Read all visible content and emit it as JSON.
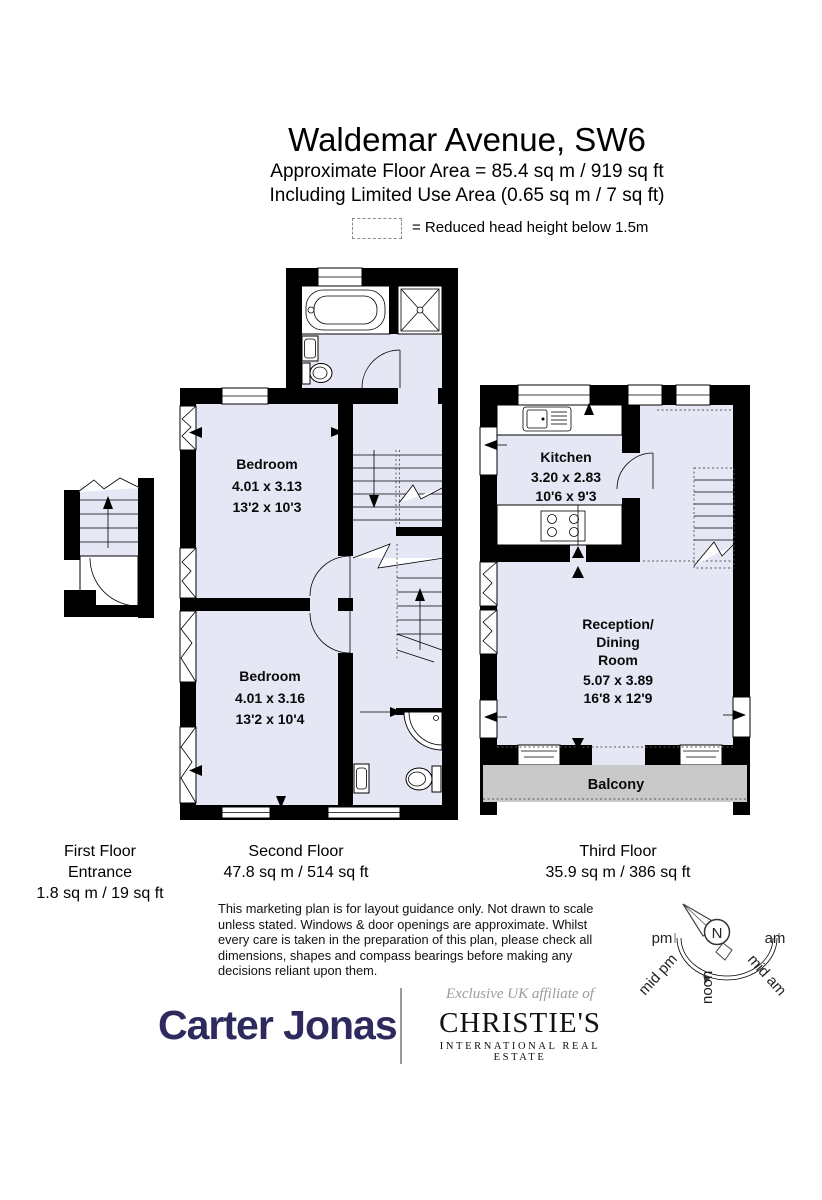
{
  "header": {
    "title": "Waldemar Avenue, SW6",
    "subtitle1": "Approximate Floor Area = 85.4 sq m / 919 sq ft",
    "subtitle2": "Including Limited Use Area (0.65 sq m / 7 sq ft)",
    "legend_label": "= Reduced head height below 1.5m"
  },
  "rooms": {
    "bedroom1": {
      "name": "Bedroom",
      "metric": "4.01 x 3.13",
      "imperial": "13'2 x 10'3"
    },
    "bedroom2": {
      "name": "Bedroom",
      "metric": "4.01 x 3.16",
      "imperial": "13'2 x 10'4"
    },
    "kitchen": {
      "name": "Kitchen",
      "metric": "3.20 x 2.83",
      "imperial": "10'6 x 9'3"
    },
    "reception": {
      "name_line1": "Reception/",
      "name_line2": "Dining",
      "name_line3": "Room",
      "metric": "5.07 x 3.89",
      "imperial": "16'8 x 12'9"
    },
    "balcony": "Balcony"
  },
  "floor_labels": {
    "first": {
      "line1": "First Floor",
      "line2": "Entrance",
      "line3": "1.8 sq m / 19 sq ft"
    },
    "second": {
      "line1": "Second Floor",
      "line2": "47.8 sq m / 514 sq ft"
    },
    "third": {
      "line1": "Third Floor",
      "line2": "35.9 sq m / 386 sq ft"
    }
  },
  "disclaimer": "This marketing plan is for layout guidance only. Not drawn to scale unless stated. Windows & door openings are approximate. Whilst every care is taken in the preparation of this plan, please check all dimensions, shapes and compass bearings before making any decisions reliant upon them.",
  "compass": {
    "north": "N",
    "left": "pm",
    "right": "am",
    "lower_left": "mid pm",
    "bottom": "noon",
    "lower_right": "mid am"
  },
  "footer": {
    "agent_logo": "Carter Jonas",
    "affiliate_line": "Exclusive UK affiliate of",
    "partner_logo": "CHRISTIE'S",
    "partner_tagline": "INTERNATIONAL REAL ESTATE"
  },
  "colors": {
    "floor_fill": "#E6E7F5",
    "wall": "#000000",
    "balcony_fill": "#C9C9C9",
    "agent_navy": "#2E2A5E",
    "muted_gray": "#9a9a9a"
  }
}
